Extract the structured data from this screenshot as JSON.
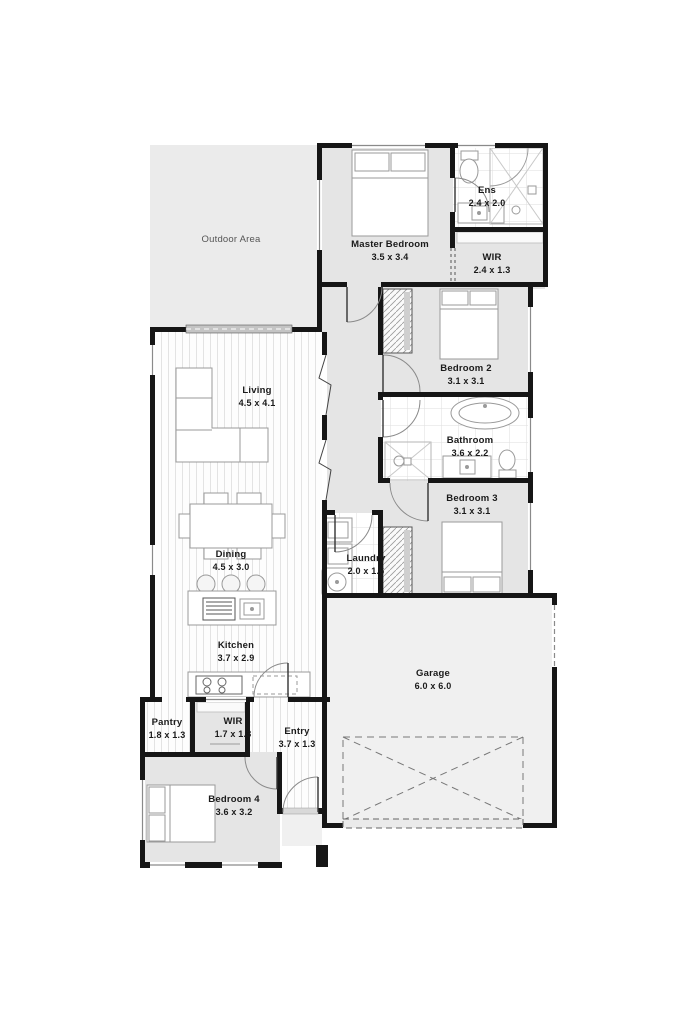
{
  "plan_title": "Single storey house floor plan",
  "colors": {
    "wall": "#161616",
    "room_fill": "#e5e5e5",
    "garage_fill": "#f0f0f0",
    "outdoor_fill": "#ebebeb",
    "text": "#1a1a1a"
  },
  "rooms": {
    "outdoor": {
      "name": "Outdoor Area",
      "dims": ""
    },
    "master": {
      "name": "Master Bedroom",
      "dims": "3.5 x 3.4"
    },
    "ens": {
      "name": "Ens",
      "dims": "2.4 x 2.0"
    },
    "wir_master": {
      "name": "WIR",
      "dims": "2.4 x 1.3"
    },
    "bedroom2": {
      "name": "Bedroom 2",
      "dims": "3.1 x 3.1"
    },
    "living": {
      "name": "Living",
      "dims": "4.5 x 4.1"
    },
    "bathroom": {
      "name": "Bathroom",
      "dims": "3.6 x 2.2"
    },
    "bedroom3": {
      "name": "Bedroom 3",
      "dims": "3.1 x 3.1"
    },
    "dining": {
      "name": "Dining",
      "dims": "4.5 x 3.0"
    },
    "laundry": {
      "name": "Laundry",
      "dims": "2.0 x 1.6"
    },
    "kitchen": {
      "name": "Kitchen",
      "dims": "3.7 x 2.9"
    },
    "garage": {
      "name": "Garage",
      "dims": "6.0 x 6.0"
    },
    "pantry": {
      "name": "Pantry",
      "dims": "1.8 x 1.3"
    },
    "wir_entry": {
      "name": "WIR",
      "dims": "1.7 x 1.3"
    },
    "entry": {
      "name": "Entry",
      "dims": "3.7 x 1.3"
    },
    "bedroom4": {
      "name": "Bedroom 4",
      "dims": "3.6 x 3.2"
    }
  }
}
